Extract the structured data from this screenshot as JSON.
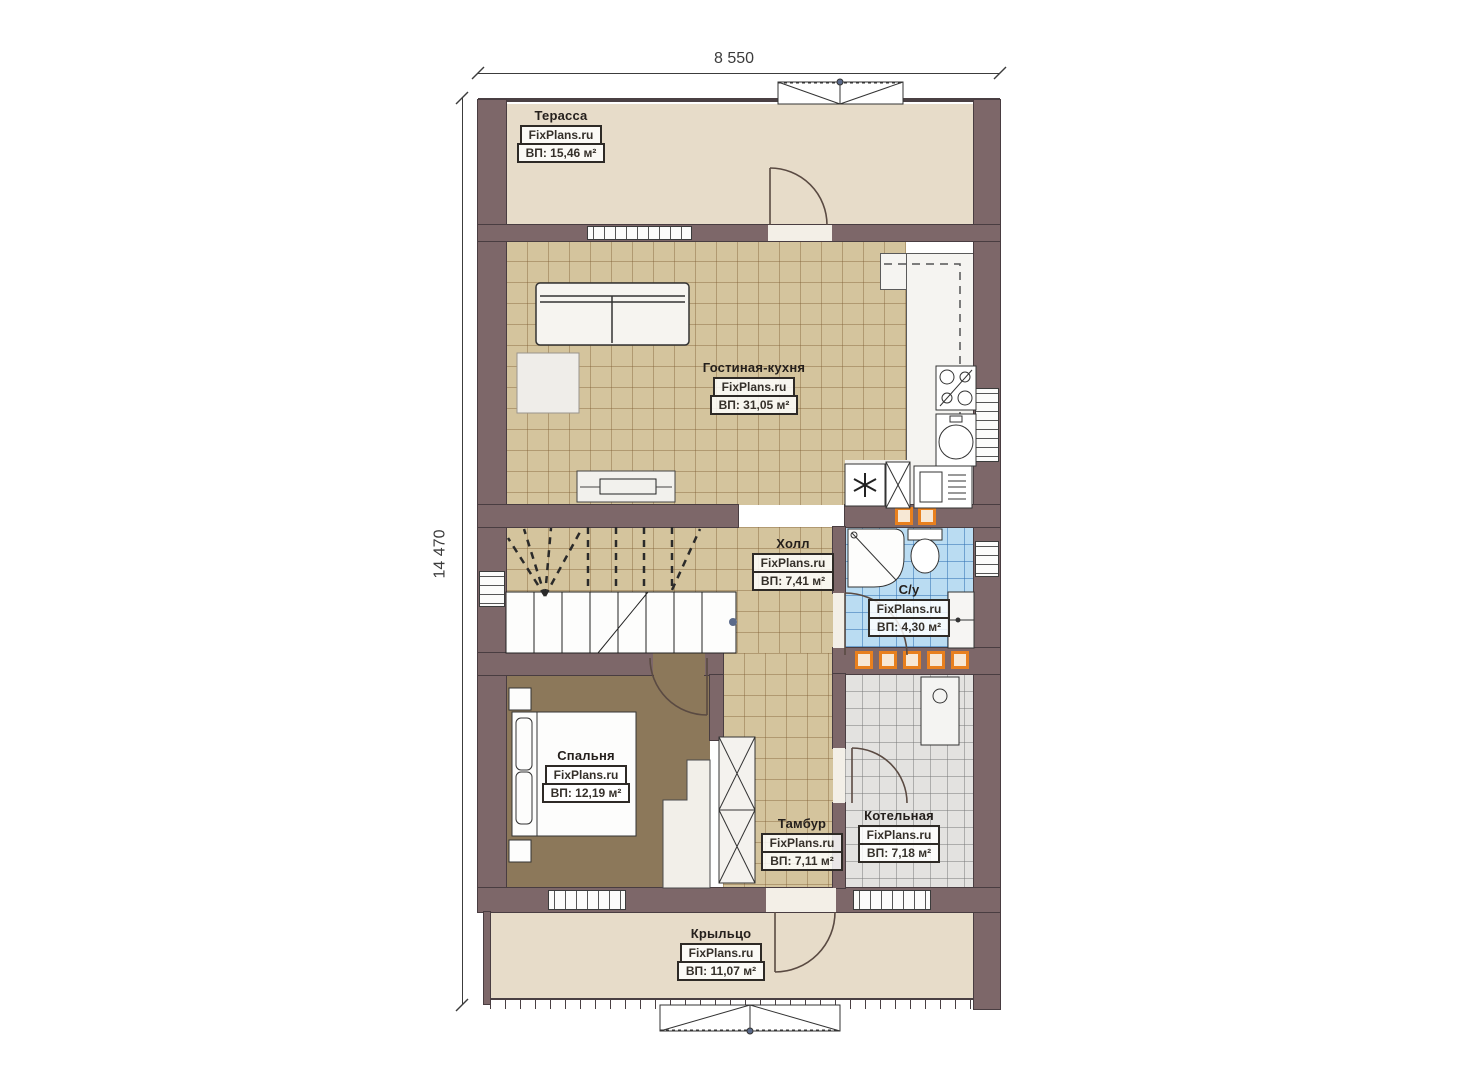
{
  "watermark": "FixPlans.ru",
  "dimensions": {
    "width_label": "8 550",
    "height_label": "14 470"
  },
  "rooms": [
    {
      "id": "terrace",
      "name": "Терасса",
      "area": "ВП: 15,46 м²"
    },
    {
      "id": "living",
      "name": "Гостиная-кухня",
      "area": "ВП: 31,05 м²"
    },
    {
      "id": "hall",
      "name": "Холл",
      "area": "ВП: 7,41 м²"
    },
    {
      "id": "bath",
      "name": "С/у",
      "area": "ВП: 4,30 м²"
    },
    {
      "id": "bedroom",
      "name": "Спальня",
      "area": "ВП: 12,19 м²"
    },
    {
      "id": "tambour",
      "name": "Тамбур",
      "area": "ВП: 7,11 м²"
    },
    {
      "id": "boiler",
      "name": "Котельная",
      "area": "ВП: 7,18 м²"
    },
    {
      "id": "porch",
      "name": "Крыльцо",
      "area": "ВП: 11,07 м²"
    }
  ],
  "colors": {
    "wall": "#7d6769",
    "floor_tile": "#d4c49d",
    "terrace_floor": "#e7dcc9",
    "bedroom_floor": "#8c785a",
    "bath_tile": "#badcf2",
    "boiler_tile": "#e3e2e0",
    "vent_accent": "#e8801e"
  }
}
